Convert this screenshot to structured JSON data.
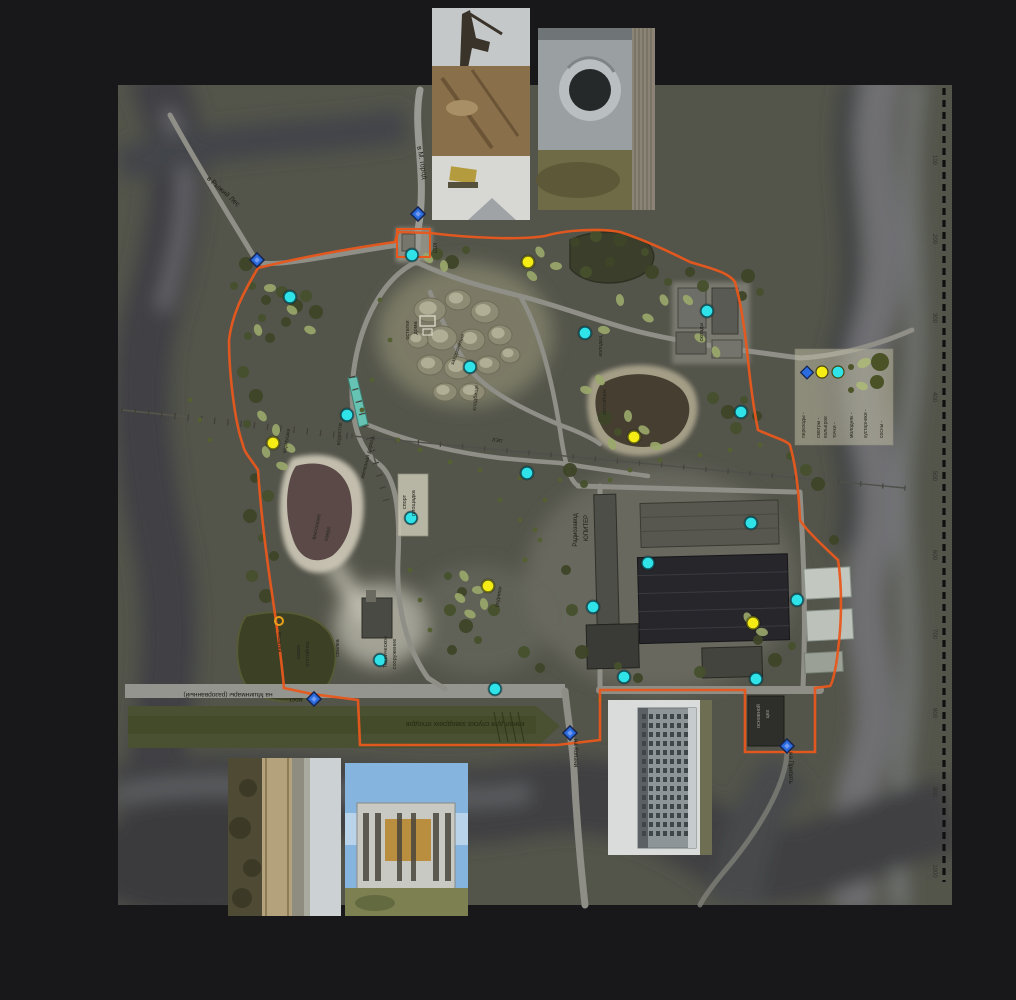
{
  "map": {
    "labels": [
      {
        "text": "в Рыжий Лес",
        "x": 222,
        "y": 193,
        "rot": 42,
        "size": 7,
        "color": "#1d1d16"
      },
      {
        "text": "в М. город",
        "x": 420,
        "y": 163,
        "rot": 80,
        "size": 7,
        "color": "#1d1d16"
      },
      {
        "text": "КПП",
        "x": 433,
        "y": 248,
        "rot": 90,
        "size": 5,
        "color": "#26261e"
      },
      {
        "text": "остатки",
        "x": 409,
        "y": 330,
        "rot": -90,
        "size": 5.5,
        "color": "#26261e"
      },
      {
        "text": "дома",
        "x": 417,
        "y": 328,
        "rot": -90,
        "size": 5.5,
        "color": "#26261e"
      },
      {
        "text": "захоронения",
        "x": 459,
        "y": 350,
        "rot": -70,
        "size": 5.5,
        "color": "#26261e"
      },
      {
        "text": "кладбище",
        "x": 477,
        "y": 398,
        "rot": -85,
        "size": 5.5,
        "color": "#26261e"
      },
      {
        "text": "колодец",
        "x": 602,
        "y": 346,
        "rot": -90,
        "size": 5.5,
        "color": "#26261e"
      },
      {
        "text": "отстойник",
        "x": 606,
        "y": 402,
        "rot": -90,
        "size": 5.5,
        "color": "#26261e"
      },
      {
        "text": "склады",
        "x": 703,
        "y": 332,
        "rot": -90,
        "size": 5.5,
        "color": "#26261e"
      },
      {
        "text": "железная дорога",
        "x": 369,
        "y": 458,
        "rot": -76,
        "size": 5.5,
        "color": "#22221a"
      },
      {
        "text": "ЛЭП",
        "x": 497,
        "y": 442,
        "rot": 10,
        "size": 5,
        "color": "#22221a"
      },
      {
        "text": "водосток",
        "x": 341,
        "y": 434,
        "rot": -85,
        "size": 5.5,
        "color": "#26261e"
      },
      {
        "text": "кормушки",
        "x": 288,
        "y": 441,
        "rot": -80,
        "size": 5.5,
        "color": "#26261e"
      },
      {
        "text": "спорт",
        "x": 406,
        "y": 502,
        "rot": -90,
        "size": 5.5,
        "color": "#26261e"
      },
      {
        "text": "площадка",
        "x": 415,
        "y": 503,
        "rot": -90,
        "size": 5.5,
        "color": "#26261e"
      },
      {
        "text": "высохшее",
        "x": 318,
        "y": 527,
        "rot": -78,
        "size": 5.5,
        "color": "#26261e"
      },
      {
        "text": "озеро",
        "x": 329,
        "y": 534,
        "rot": -78,
        "size": 5.5,
        "color": "#26261e"
      },
      {
        "text": "Радиозавод",
        "x": 577,
        "y": 530,
        "rot": -90,
        "size": 6,
        "color": "#1c1c16"
      },
      {
        "text": "ЮПИТЕР",
        "x": 588,
        "y": 528,
        "rot": -90,
        "size": 6,
        "color": "#1c1c16"
      },
      {
        "text": "озеро",
        "x": 300,
        "y": 652,
        "rot": -90,
        "size": 5.5,
        "color": "#26261e"
      },
      {
        "text": "отстойник",
        "x": 309,
        "y": 654,
        "rot": -90,
        "size": 5.5,
        "color": "#26261e"
      },
      {
        "text": "свалка",
        "x": 339,
        "y": 648,
        "rot": -90,
        "size": 5.5,
        "color": "#26261e"
      },
      {
        "text": "Техническое",
        "x": 387,
        "y": 652,
        "rot": -90,
        "size": 5.5,
        "color": "#26261e"
      },
      {
        "text": "сооружение",
        "x": 396,
        "y": 654,
        "rot": -90,
        "size": 5.5,
        "color": "#26261e"
      },
      {
        "text": "калитка",
        "x": 281,
        "y": 642,
        "rot": -90,
        "size": 5.5,
        "color": "#26261e"
      },
      {
        "text": "родники",
        "x": 500,
        "y": 597,
        "rot": -80,
        "size": 5.5,
        "color": "#26261e"
      },
      {
        "text": "мост",
        "x": 296,
        "y": 698,
        "rot": 180,
        "size": 6,
        "color": "#1d1d16"
      },
      {
        "text": "на Мшинмары (разорванный)",
        "x": 228,
        "y": 693,
        "rot": 180,
        "size": 6.5,
        "color": "#1d1d16"
      },
      {
        "text": "канал для спуска заводских отходов",
        "x": 465,
        "y": 722,
        "rot": 180,
        "size": 7,
        "color": "#252a12"
      },
      {
        "text": "на Копачи",
        "x": 574,
        "y": 753,
        "rot": 90,
        "size": 6,
        "color": "#1d1d16"
      },
      {
        "text": "основной",
        "x": 760,
        "y": 716,
        "rot": -90,
        "size": 5.5,
        "color": "#9a9a8e"
      },
      {
        "text": "цех",
        "x": 769,
        "y": 714,
        "rot": -90,
        "size": 5.5,
        "color": "#9a9a8e"
      },
      {
        "text": "на Припять",
        "x": 789,
        "y": 768,
        "rot": 90,
        "size": 6,
        "color": "#1d1d16"
      }
    ],
    "legend": {
      "markers": [
        {
          "symbol": "crossing-diamond",
          "label": "переходы"
        },
        {
          "symbol": "yellow-circle",
          "label": "смотры вольеров"
        },
        {
          "symbol": "cyan-circle",
          "label": "точки"
        }
      ],
      "vegetation": [
        {
          "symbol": "young-growth-dots",
          "label": "молодняк"
        },
        {
          "symbol": "bushes",
          "label": "кустарники"
        },
        {
          "symbol": "pines",
          "label": "сосны"
        }
      ]
    },
    "ruler": {
      "values": [
        100,
        200,
        300,
        400,
        500,
        600,
        700,
        800,
        900,
        1000
      ]
    },
    "markers": {
      "cyan_points": [
        [
          290,
          297
        ],
        [
          412,
          255
        ],
        [
          470,
          367
        ],
        [
          585,
          333
        ],
        [
          707,
          311
        ],
        [
          741,
          412
        ],
        [
          347,
          415
        ],
        [
          527,
          473
        ],
        [
          411,
          518
        ],
        [
          648,
          563
        ],
        [
          751,
          523
        ],
        [
          593,
          607
        ],
        [
          797,
          600
        ],
        [
          380,
          660
        ],
        [
          495,
          689
        ],
        [
          624,
          677
        ],
        [
          756,
          679
        ]
      ],
      "yellow_points": [
        [
          273,
          443
        ],
        [
          528,
          262
        ],
        [
          634,
          437
        ],
        [
          488,
          586
        ],
        [
          753,
          623
        ]
      ],
      "crossings": [
        [
          257,
          260
        ],
        [
          418,
          214
        ],
        [
          314,
          699
        ],
        [
          570,
          733
        ],
        [
          787,
          746
        ]
      ],
      "gate_rings": [
        [
          279,
          621
        ]
      ]
    },
    "photos": [
      {
        "name": "photo-industrial-ruins"
      },
      {
        "name": "photo-culvert-pipe"
      },
      {
        "name": "photo-canal-road"
      },
      {
        "name": "photo-ruined-building"
      },
      {
        "name": "photo-factory-building"
      }
    ],
    "colors": {
      "background": "#18181b",
      "terrain": "#53544a",
      "fence": "#e8581c",
      "road": "#98978f",
      "canal": "#4a5132",
      "water_dark": "#463e32",
      "cyan_marker": "#2fe3e8",
      "yellow_marker": "#f4ec14",
      "crossing_marker": "#2b6be0"
    }
  }
}
